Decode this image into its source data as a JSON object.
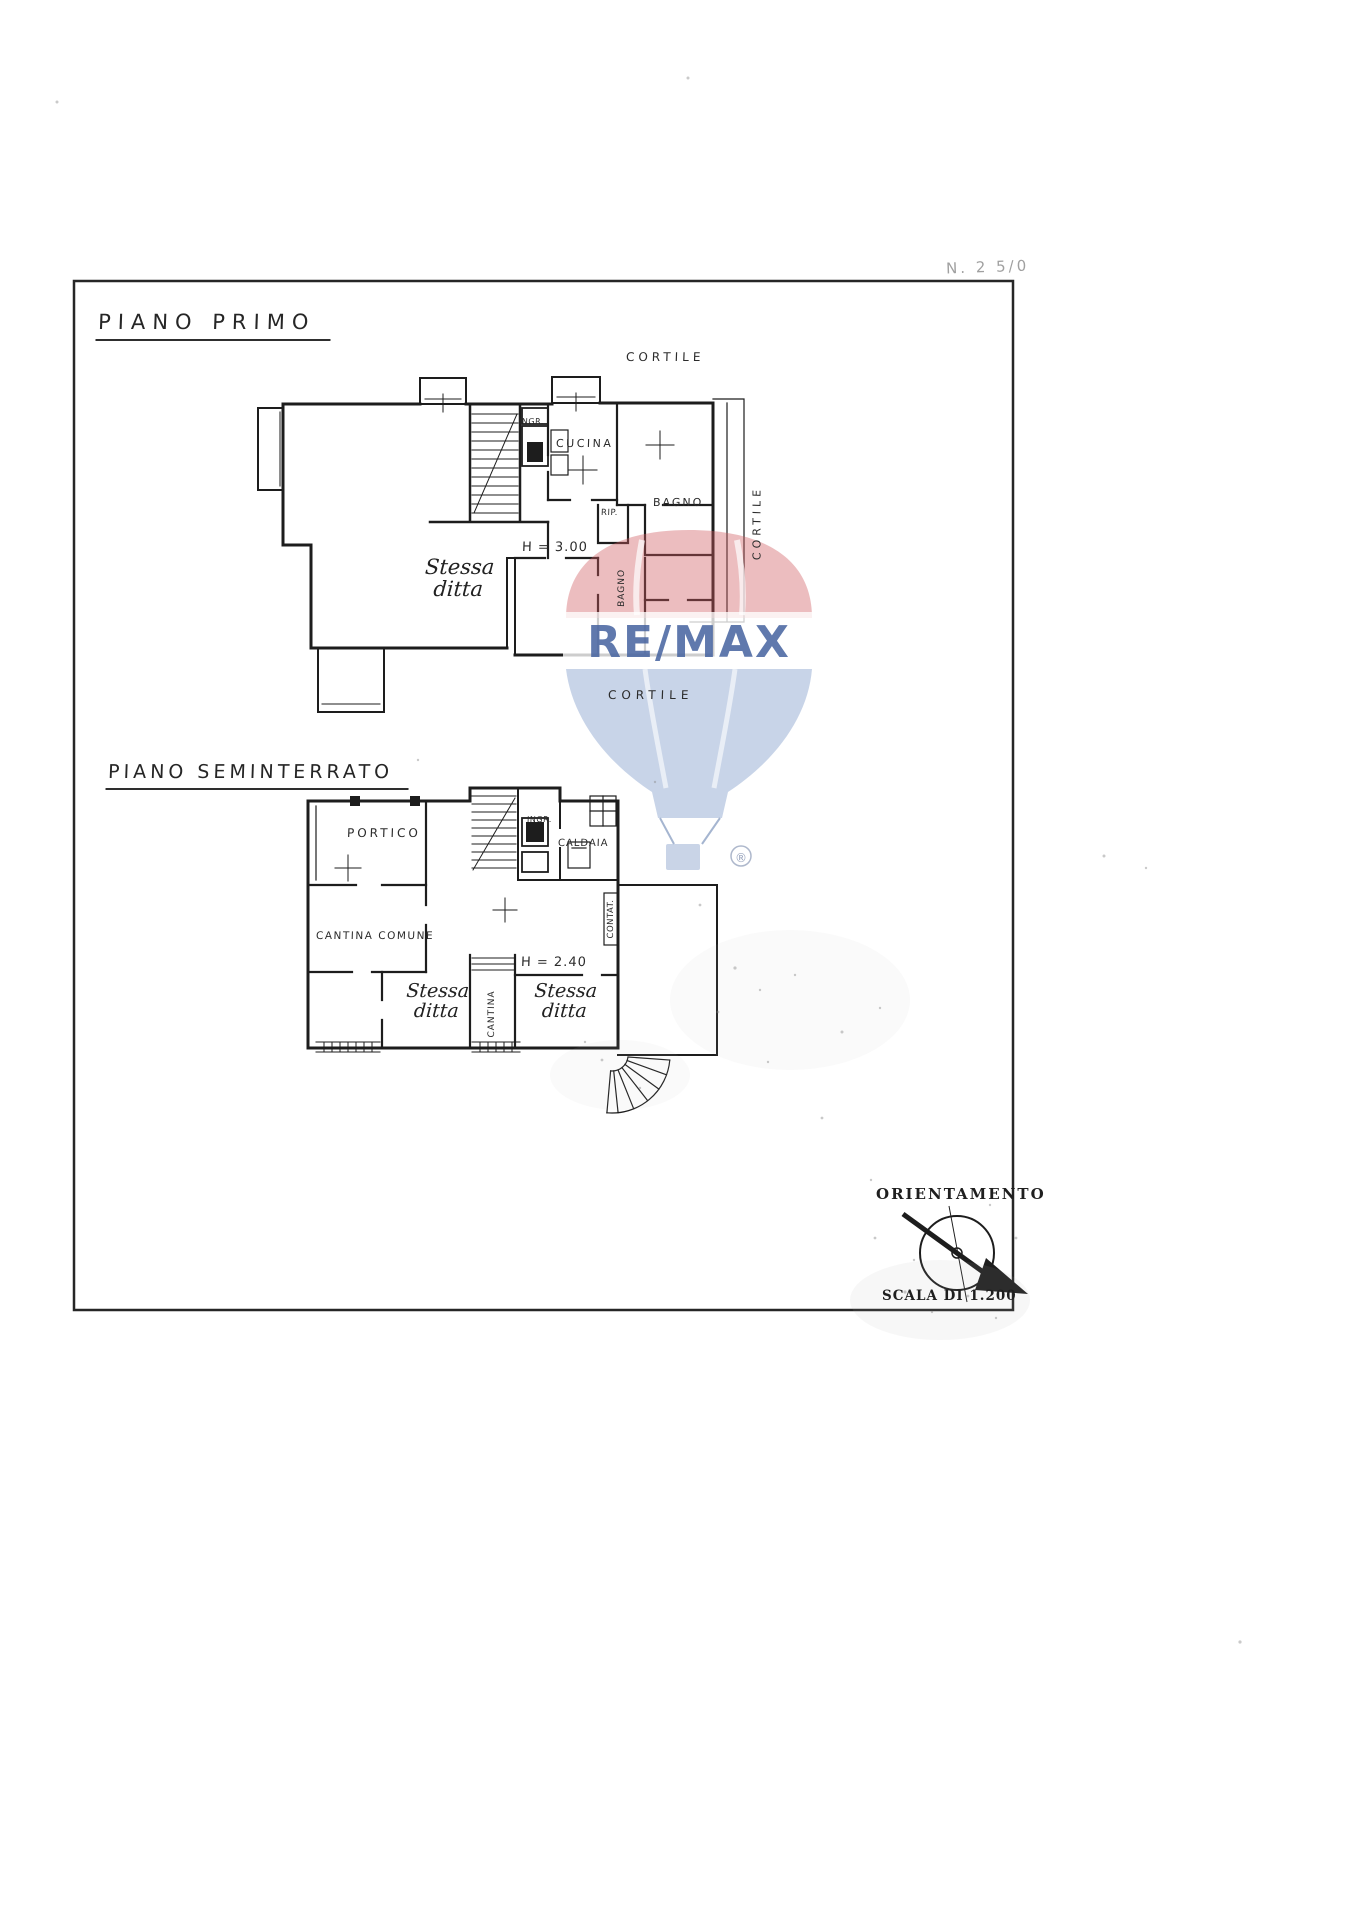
{
  "document": {
    "corner_note": "N. 2 5/0"
  },
  "first_floor": {
    "title": "PIANO PRIMO",
    "cortile_top": "CORTILE",
    "ingresso": "INGR.",
    "cucina": "CUCINA",
    "bagno": "BAGNO",
    "ripostiglio": "RIP.",
    "height_note": "H = 3.00",
    "stessa_line1": "Stessa",
    "stessa_line2": "ditta",
    "bagno_vertical": "BAGNO",
    "cortile_right": "CORTILE",
    "cortile_bottom": "CORTILE"
  },
  "basement": {
    "title": "PIANO SEMINTERRATO",
    "portico": "PORTICO",
    "ingresso": "INGR.",
    "caldaia": "CALDAIA",
    "cantina_comune": "CANTINA COMUNE",
    "contatori": "CONTAT.",
    "height_note": "H = 2.40",
    "stessa_line1": "Stessa",
    "stessa_line2": "ditta",
    "cantina_vertical": "CANTINA"
  },
  "compass": {
    "title": "ORIENTAMENTO",
    "scale_label": "SCALA DI 1.200"
  },
  "watermark": {
    "brand": "RE/MAX",
    "registered": "®",
    "balloon_red": "#cf5a60",
    "balloon_blue": "#7d99c9",
    "text_blue": "#44629f"
  }
}
